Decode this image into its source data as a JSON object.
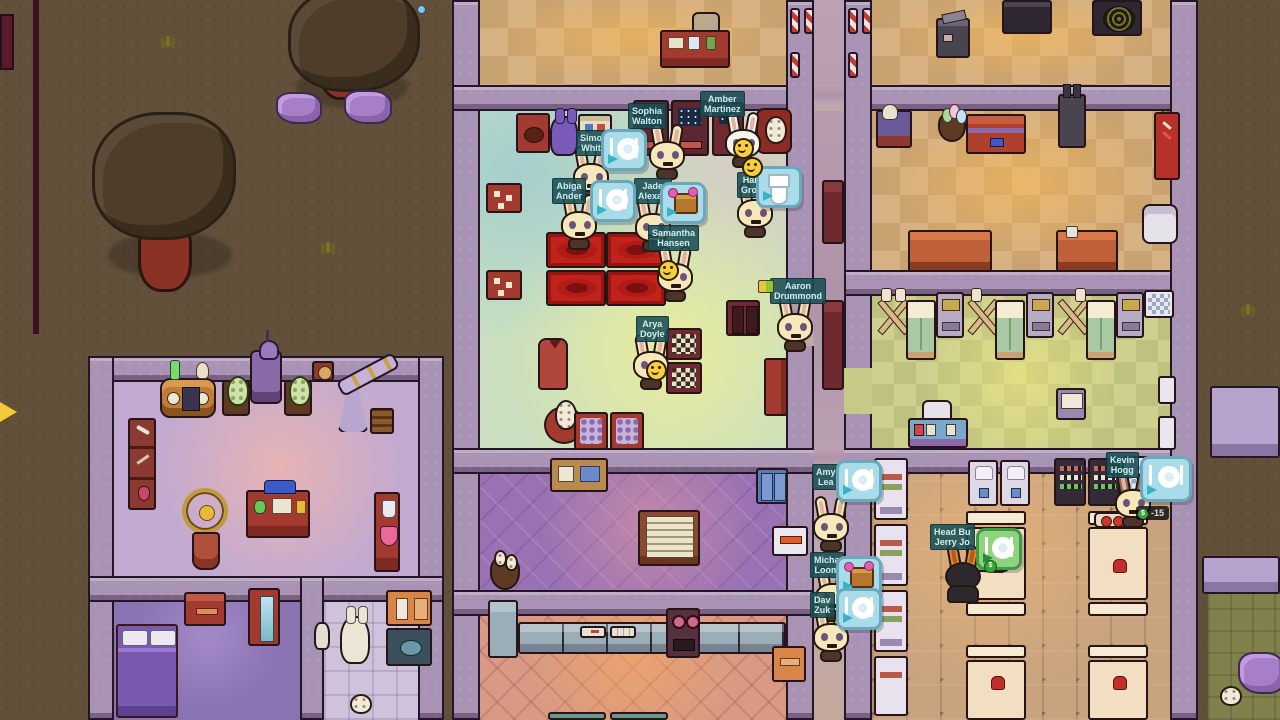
{
  "hud": {
    "money_delta": "-15"
  },
  "characters": [
    {
      "id": "simon-white",
      "label": "Simo\nWhit",
      "thought": "eat"
    },
    {
      "id": "sophia-walton",
      "label": "Sophia\nWalton",
      "thought": null
    },
    {
      "id": "amber-martinez",
      "label": "Amber\nMartinez",
      "mood": "happy"
    },
    {
      "id": "hannah-gross",
      "label": "Hann\nGross",
      "thought": "toilet"
    },
    {
      "id": "abigail-anderson",
      "label": "Abiga\nAnder",
      "thought": "eat"
    },
    {
      "id": "jade-alexander",
      "label": "Jade\nAlexan",
      "thought": "gift"
    },
    {
      "id": "samantha-hansen",
      "label": "Samantha\nHansen",
      "mood": "happy"
    },
    {
      "id": "arya-doyle",
      "label": "Arya\nDoyle",
      "mood": "happy"
    },
    {
      "id": "aaron-drummond",
      "label": "Aaron\nDrummond",
      "thought": null
    },
    {
      "id": "amy-lea",
      "label": "Amy\nLea",
      "thought": "eat"
    },
    {
      "id": "michael-loomis",
      "label": "Micha\nLoom",
      "thought": "gift"
    },
    {
      "id": "david-zuke",
      "label": "Dav\nZuk",
      "thought": "eat"
    },
    {
      "id": "kevin-hogg",
      "label": "Kevin\nHogg",
      "thought": "eat"
    },
    {
      "id": "jerry-head-builder",
      "label": "Head Bu\nJerry Jo",
      "thought": "eat"
    }
  ],
  "icons": {
    "eat": "plate-and-cutlery-with-arrow",
    "gift": "gift-box-with-arrow",
    "toilet": "toilet",
    "money": "dollar-coin",
    "happy": "smiley-face"
  },
  "colors": {
    "ground": "#63503a",
    "wall": "#a893b4",
    "wall_outline": "#241627",
    "bubble": "#a9dbe8",
    "bubble_green": "#8ed47e",
    "nametag_bg": "#1a4e54",
    "nametag_text": "#cfeef0",
    "accent_red": "#c1231c",
    "rock_purple": "#a77fc8",
    "money_green": "#3aa33a"
  }
}
